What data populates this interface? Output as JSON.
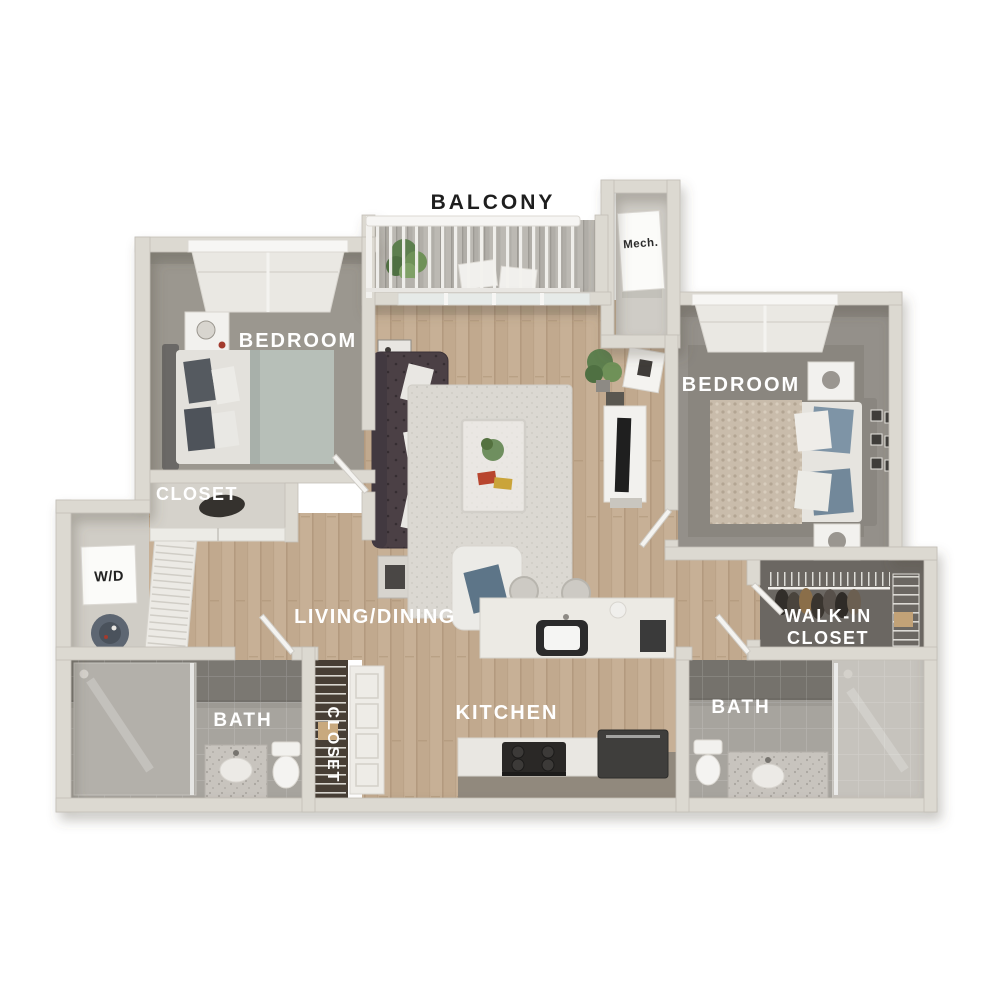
{
  "labels": {
    "balcony": "BALCONY",
    "mech": "Mech.",
    "bedroom_left": "BEDROOM",
    "bedroom_right": "BEDROOM",
    "bedroom_closet": "CLOSET",
    "washer_dryer": "W/D",
    "living_dining": "LIVING/DINING",
    "kitchen": "KITCHEN",
    "bath_left": "BATH",
    "bath_right": "BATH",
    "hall_closet": "CLOSET",
    "walk_in_line1": "WALK-IN",
    "walk_in_line2": "CLOSET"
  },
  "colors": {
    "background": "#ffffff",
    "wall": "#dcd9d1",
    "wall_edge": "#c2bfb7",
    "wood_floor": "#c5ae94",
    "carpet_left": "#9b978f",
    "carpet_right": "#94908a",
    "tile_floor": "#a7a49e",
    "tile_wall_dark": "#7b7872",
    "closet_dark_floor": "#6b6762",
    "label_light": "#ffffff",
    "label_dark": "#1e1e1e",
    "sofa": "#4b4045",
    "accent_plant": "#6f9158"
  }
}
